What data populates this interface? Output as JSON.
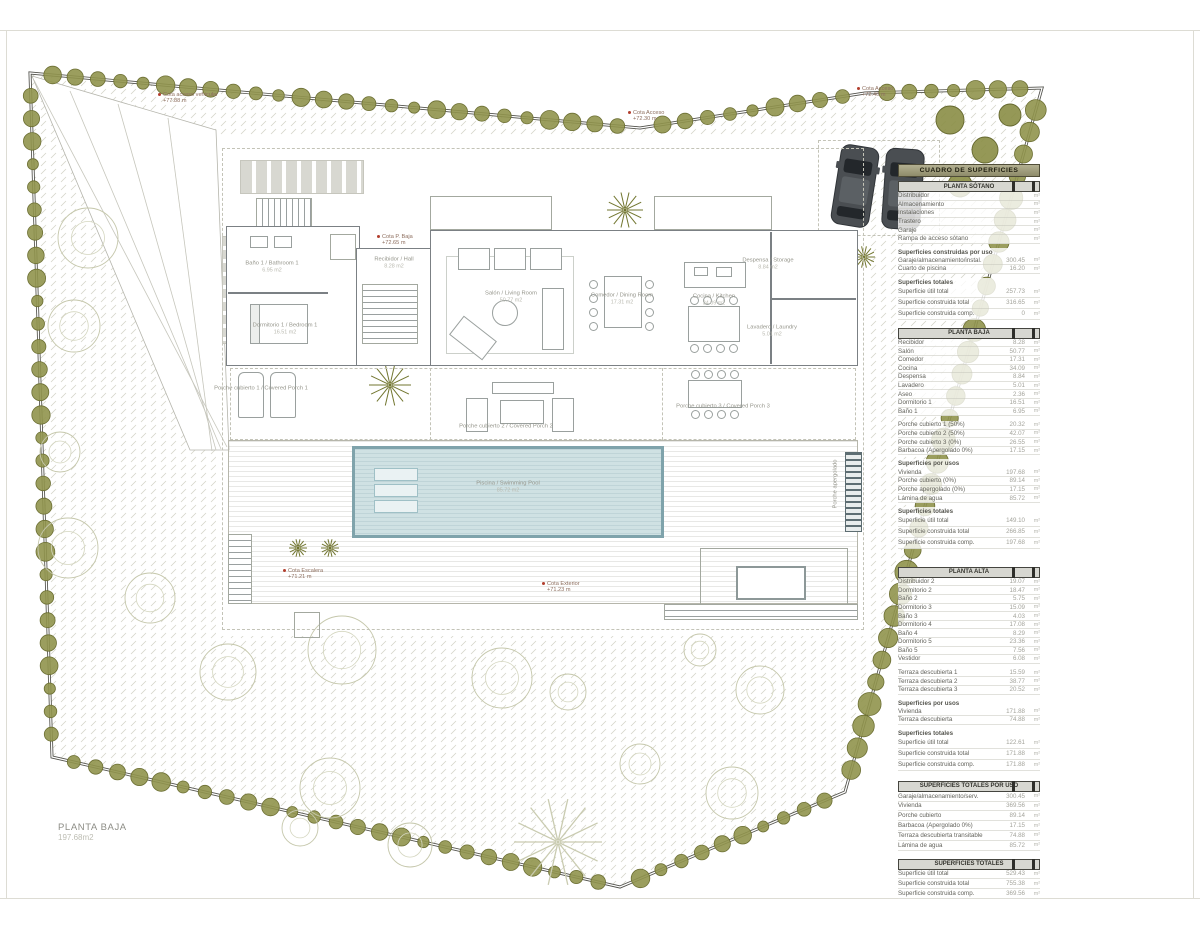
{
  "sheet": {
    "title": "PLANTA BAJA",
    "area": "197.68m2"
  },
  "colors": {
    "hedge": "#8f9249",
    "water": "#cfe1e3",
    "table_header": "#938f6c",
    "cota_marker": "#b23f2e",
    "wall": "#7b8084"
  },
  "rooms": [
    {
      "id": "salon",
      "name": "Salón / Living Room",
      "area": "50.77 m2"
    },
    {
      "id": "comedor",
      "name": "Comedor / Dining Room",
      "area": "17.31 m2"
    },
    {
      "id": "cocina",
      "name": "Cocina / Kitchen",
      "area": "34.09 m2"
    },
    {
      "id": "despensa",
      "name": "Despensa / Storage",
      "area": "8.84 m2"
    },
    {
      "id": "lavadero",
      "name": "Lavadero / Laundry",
      "area": "5.01 m2"
    },
    {
      "id": "bano1",
      "name": "Baño 1 / Bathroom 1",
      "area": "6.95 m2"
    },
    {
      "id": "dorm1",
      "name": "Dormitorio 1 / Bedroom 1",
      "area": "16.51 m2"
    },
    {
      "id": "hall",
      "name": "Recibidor / Hall",
      "area": "8.28 m2"
    },
    {
      "id": "porche1",
      "name": "Porche cubierto 1 / Covered Porch 1",
      "area": ""
    },
    {
      "id": "porche2",
      "name": "Porche cubierto 2 / Covered Porch 2",
      "area": ""
    },
    {
      "id": "porche3",
      "name": "Porche cubierto 3 / Covered Porch 3",
      "area": ""
    },
    {
      "id": "piscina",
      "name": "Piscina / Swimming Pool",
      "area": "85.72 m2"
    },
    {
      "id": "apergolado",
      "name": "Porche apergolado",
      "area": ""
    }
  ],
  "cotas": [
    {
      "id": "acceso-vehicular",
      "label": "Cota acceso vehicular",
      "value": "+77.88 m"
    },
    {
      "id": "acceso-1",
      "label": "Cota Acceso",
      "value": "+72.30 m"
    },
    {
      "id": "acceso-2",
      "label": "Cota Acceso",
      "value": "+72.40 m"
    },
    {
      "id": "p-baja",
      "label": "Cota P. Baja",
      "value": "+72.65 m"
    },
    {
      "id": "escalera",
      "label": "Cota Escalera",
      "value": "+71.21 m"
    },
    {
      "id": "exterior",
      "label": "Cota Exterior",
      "value": "+71.23 m"
    }
  ],
  "table": {
    "title": "CUADRO DE SUPERFICIES",
    "unit": "m²",
    "sections": [
      {
        "bar": "PLANTA SÓTANO",
        "blocks": [
          {
            "rows": [
              {
                "label": "Distribuidor",
                "value": ""
              },
              {
                "label": "Almacenamiento",
                "value": ""
              },
              {
                "label": "Instalaciones",
                "value": ""
              },
              {
                "label": "Trastero",
                "value": ""
              },
              {
                "label": "Garaje",
                "value": ""
              },
              {
                "label": "Rampa de acceso sótano",
                "value": ""
              }
            ]
          },
          {
            "header": "Superficies construidas por uso",
            "rows": [
              {
                "label": "Garaje/almacenamiento/instal.",
                "value": "300.45"
              },
              {
                "label": "Cuarto de piscina",
                "value": "16.20"
              }
            ]
          },
          {
            "header": "Superficies totales",
            "rows": [
              {
                "label": "Superficie útil total",
                "value": "257.73"
              },
              {
                "label": "Superficie construida total",
                "value": "316.65"
              },
              {
                "label": "Superficie construida comp.",
                "value": "0"
              }
            ]
          }
        ]
      },
      {
        "bar": "PLANTA BAJA",
        "blocks": [
          {
            "rows": [
              {
                "label": "Recibidor",
                "value": "8.28"
              },
              {
                "label": "Salón",
                "value": "50.77"
              },
              {
                "label": "Comedor",
                "value": "17.31"
              },
              {
                "label": "Cocina",
                "value": "34.09"
              },
              {
                "label": "Despensa",
                "value": "8.84"
              },
              {
                "label": "Lavadero",
                "value": "5.01"
              },
              {
                "label": "Aseo",
                "value": "2.36"
              },
              {
                "label": "Dormitorio 1",
                "value": "16.51"
              },
              {
                "label": "Baño 1",
                "value": "6.95"
              }
            ]
          },
          {
            "rows": [
              {
                "label": "Porche cubierto 1 (50%)",
                "value": "20.32"
              },
              {
                "label": "Porche cubierto 2 (50%)",
                "value": "42.07"
              },
              {
                "label": "Porche cubierto 3 (0%)",
                "value": "26.55"
              },
              {
                "label": "Barbacoa (Apergolado 0%)",
                "value": "17.15"
              }
            ]
          },
          {
            "header": "Superficies por usos",
            "rows": [
              {
                "label": "Vivienda",
                "value": "197.68"
              },
              {
                "label": "Porche cubierto (0%)",
                "value": "89.14"
              },
              {
                "label": "Porche apergolado (0%)",
                "value": "17.15"
              },
              {
                "label": "Lámina de agua",
                "value": "85.72"
              }
            ]
          },
          {
            "header": "Superficies totales",
            "rows": [
              {
                "label": "Superficie útil total",
                "value": "149.10"
              },
              {
                "label": "Superficie construida total",
                "value": "266.85"
              },
              {
                "label": "Superficie construida comp.",
                "value": "197.68"
              }
            ]
          }
        ]
      },
      {
        "bar": "PLANTA ALTA",
        "blocks": [
          {
            "rows": [
              {
                "label": "Distribuidor 2",
                "value": "19.07"
              },
              {
                "label": "Dormitorio 2",
                "value": "18.47"
              },
              {
                "label": "Baño 2",
                "value": "5.75"
              },
              {
                "label": "Dormitorio 3",
                "value": "15.09"
              },
              {
                "label": "Baño 3",
                "value": "4.03"
              },
              {
                "label": "Dormitorio 4",
                "value": "17.08"
              },
              {
                "label": "Baño 4",
                "value": "8.29"
              },
              {
                "label": "Dormitorio 5",
                "value": "23.36"
              },
              {
                "label": "Baño 5",
                "value": "7.56"
              },
              {
                "label": "Vestidor",
                "value": "6.08"
              }
            ]
          },
          {
            "rows": [
              {
                "label": "Terraza descubierta 1",
                "value": "15.59"
              },
              {
                "label": "Terraza descubierta 2",
                "value": "38.77"
              },
              {
                "label": "Terraza descubierta 3",
                "value": "20.52"
              }
            ]
          },
          {
            "header": "Superficies por usos",
            "rows": [
              {
                "label": "Vivienda",
                "value": "171.88"
              },
              {
                "label": "Terraza descubierta",
                "value": "74.88"
              }
            ]
          },
          {
            "header": "Superficies totales",
            "rows": [
              {
                "label": "Superficie útil total",
                "value": "122.61"
              },
              {
                "label": "Superficie construida total",
                "value": "171.88"
              },
              {
                "label": "Superficie construida comp.",
                "value": "171.88"
              }
            ]
          }
        ]
      },
      {
        "bar": "SUPERFICIES TOTALES POR USO",
        "blocks": [
          {
            "rows": [
              {
                "label": "Garaje/almacenamiento/serv.",
                "value": "300.45"
              },
              {
                "label": "Vivienda",
                "value": "369.56"
              },
              {
                "label": "Porche cubierto",
                "value": "89.14"
              },
              {
                "label": "Barbacoa (Apergolado 0%)",
                "value": "17.15"
              },
              {
                "label": "Terraza descubierta transitable",
                "value": "74.88"
              },
              {
                "label": "Lámina de agua",
                "value": "85.72"
              }
            ]
          }
        ]
      },
      {
        "bar": "SUPERFICIES TOTALES",
        "blocks": [
          {
            "rows": [
              {
                "label": "Superficie útil total",
                "value": "529.43"
              },
              {
                "label": "Superficie construida total",
                "value": "755.38"
              },
              {
                "label": "Superficie construida comp.",
                "value": "369.56"
              }
            ]
          }
        ]
      }
    ]
  }
}
